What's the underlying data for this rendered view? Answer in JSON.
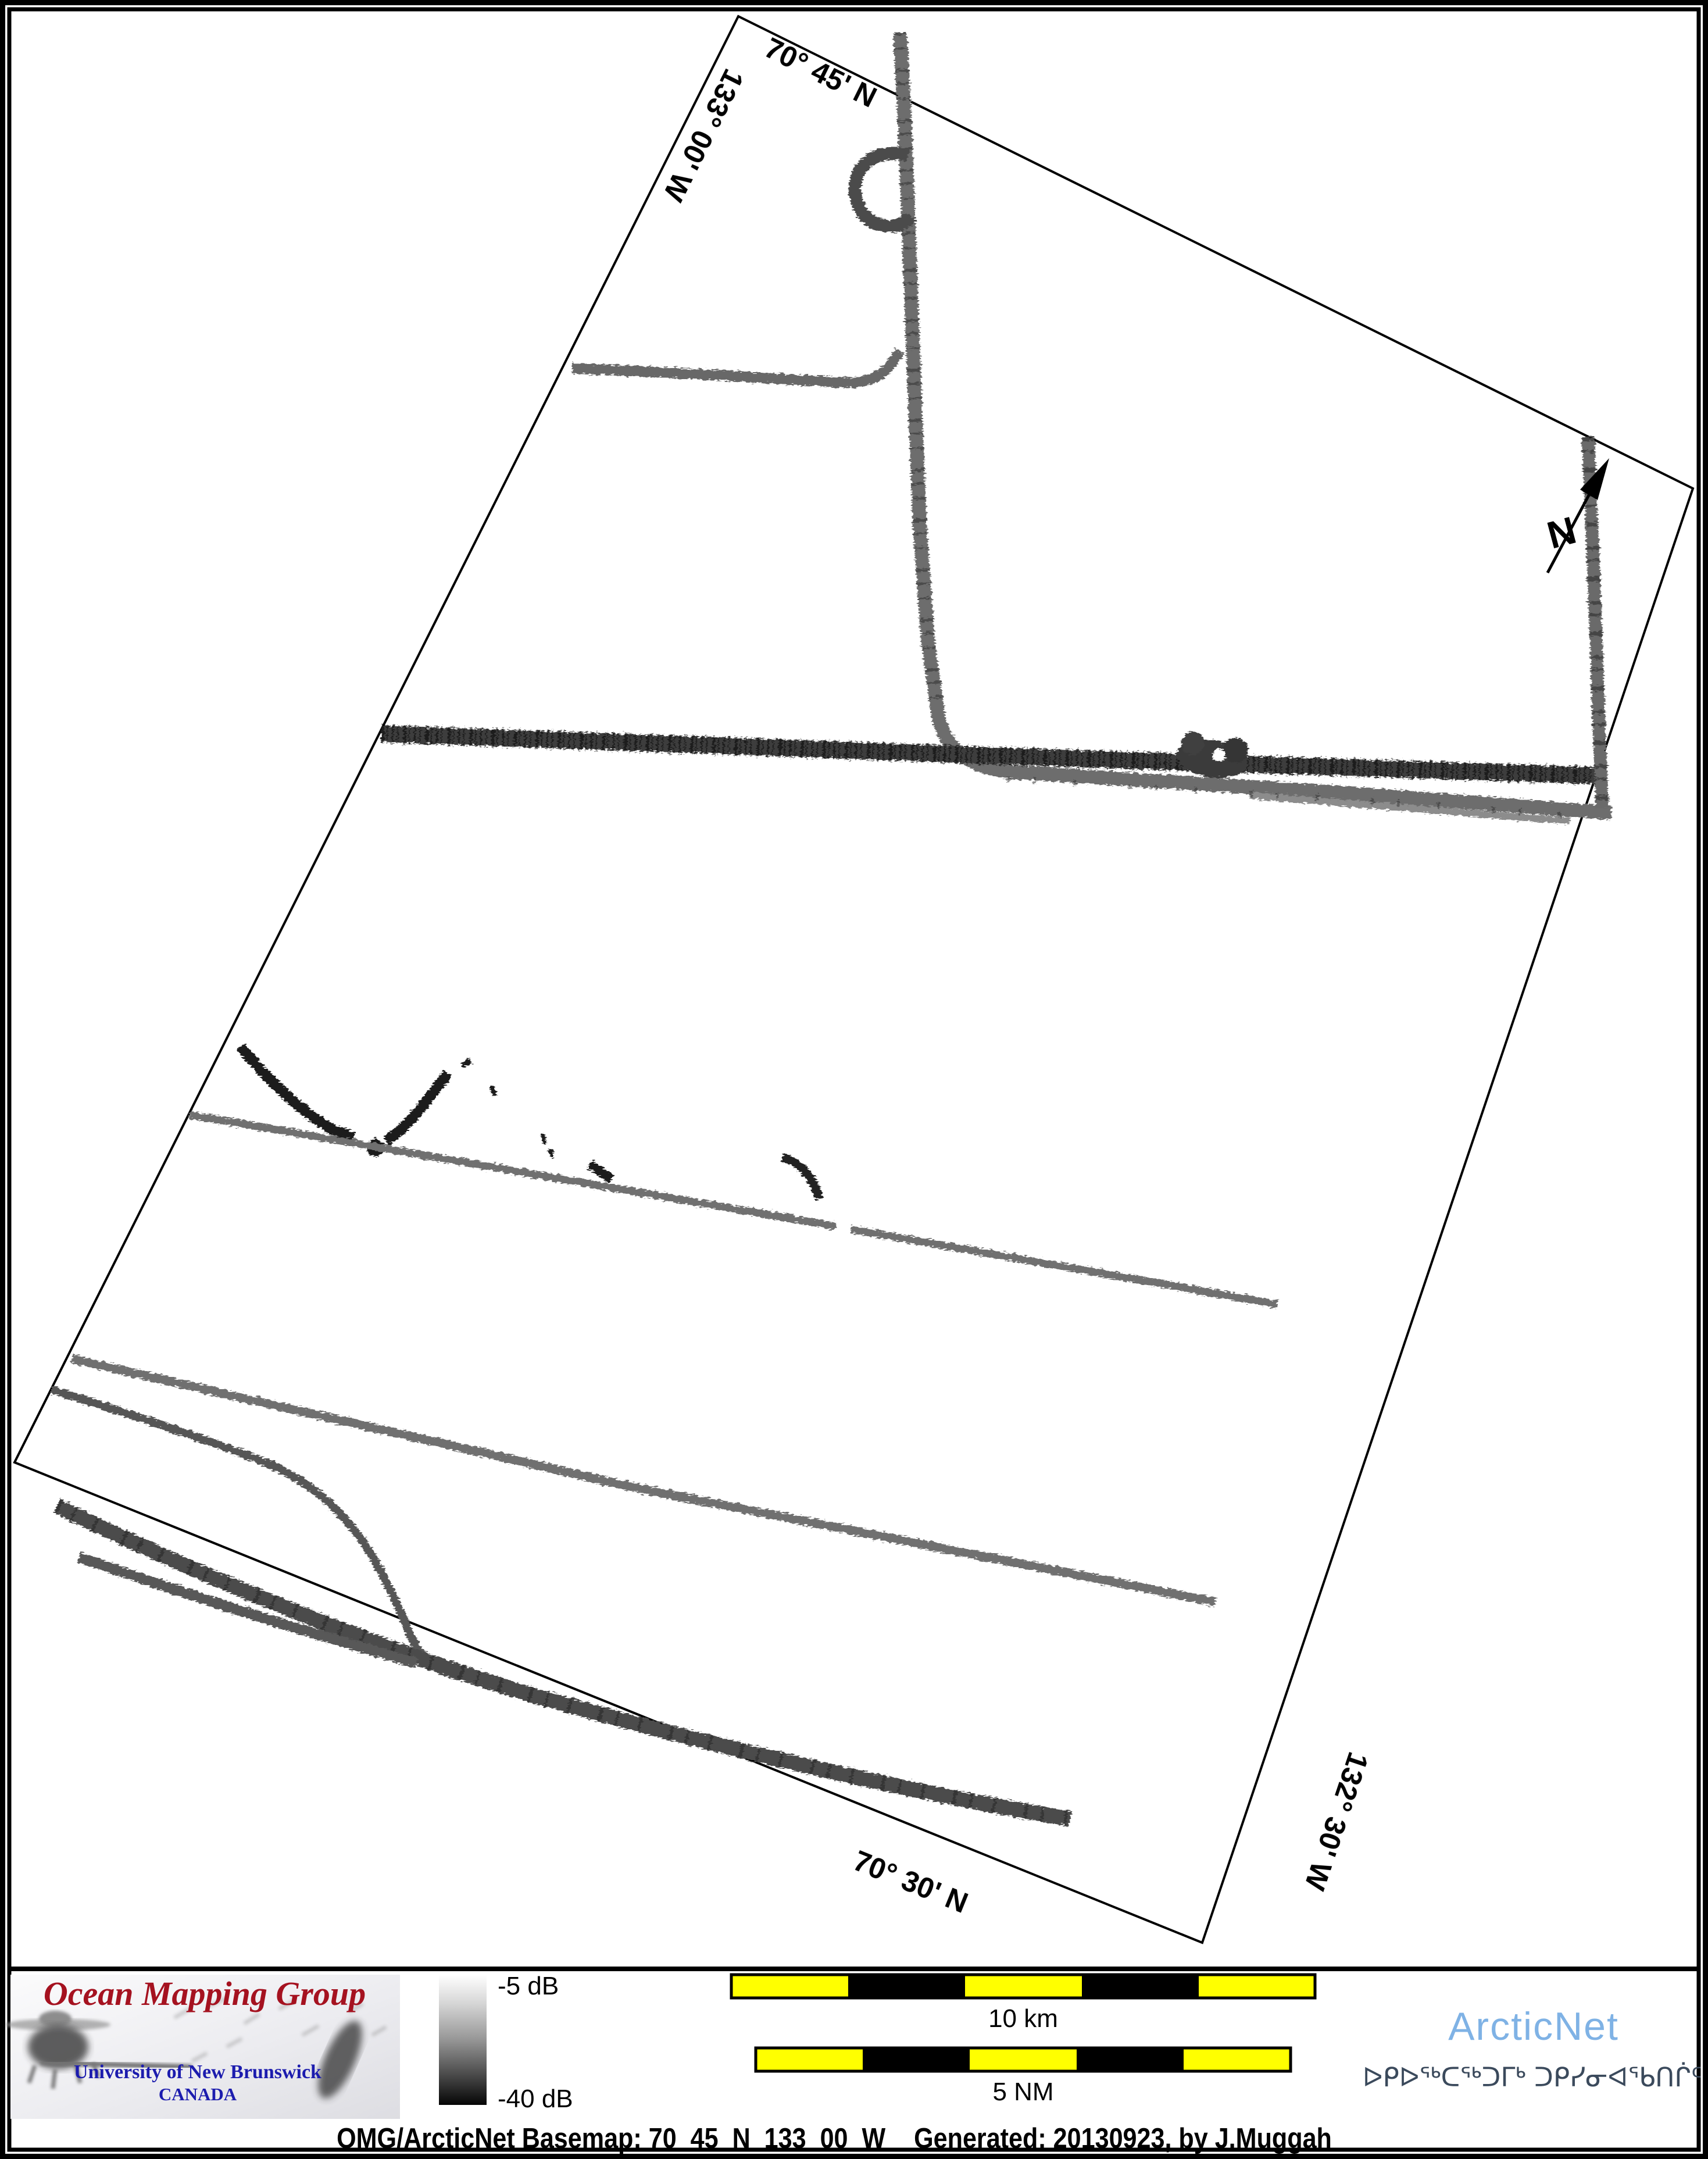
{
  "map": {
    "frame_labels": {
      "top_lat": "70° 45' N",
      "left_lon": "133° 00' W",
      "bottom_lat": "70° 30' N",
      "right_lon": "132° 30' W"
    },
    "north_label": "N",
    "features": [
      "survey-track-vertical-north",
      "survey-track-hook",
      "survey-track-spur-west",
      "survey-track-main-dark-band",
      "survey-track-parallel-band",
      "survey-track-vertical-east",
      "survey-track-crossing-knot",
      "survey-track-v-segment",
      "survey-track-small-hook",
      "survey-track-long-diagonals",
      "survey-track-southwest-fan"
    ]
  },
  "legend": {
    "omg": {
      "title": "Ocean Mapping Group",
      "university": "University of New Brunswick",
      "country": "CANADA"
    },
    "colorbar": {
      "top_label": "-5 dB",
      "bottom_label": "-40 dB"
    },
    "scalebars": [
      {
        "label": "10 km",
        "segments": 5
      },
      {
        "label": "5 NM",
        "segments": 5
      }
    ],
    "arcticnet": {
      "name": "ArcticNet",
      "inuktitut": "ᐅᑭᐅᖅᑕᖅᑐᒥᒃ ᑐᑭᓯᓂᐊᖃᑎᒌᑦ"
    }
  },
  "footer": {
    "caption_map": "OMG/ArcticNet Basemap: 70_45_N_133_00_W",
    "caption_generated": "Generated: 20130923, by J.Muggah"
  },
  "colors": {
    "scalebar_yellow": "#ffff00",
    "scalebar_black": "#000000",
    "omg_red": "#a51220",
    "unb_blue": "#1c1cae",
    "arcticnet_blue": "#7fb2e5",
    "inuktitut_slate": "#3b4a5c",
    "track_dark": "#2e2e2e",
    "track_gray": "#6f6f6f"
  }
}
